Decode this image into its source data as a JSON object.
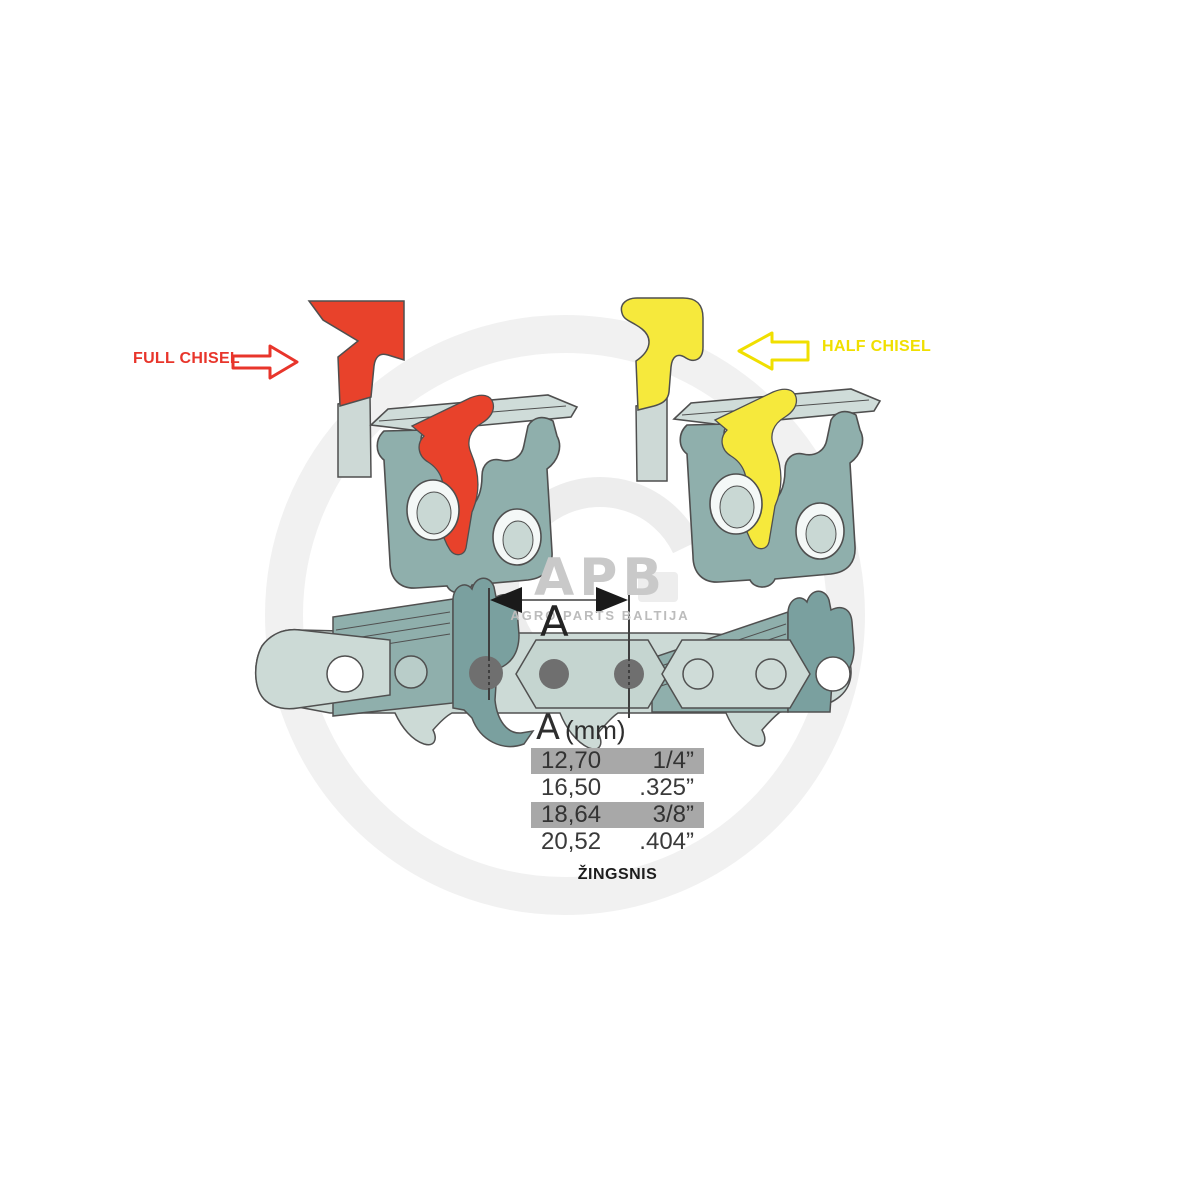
{
  "watermark": {
    "logo": "APB",
    "subtitle": "AGRO PARTS BALTIJA"
  },
  "annotations": {
    "full_chisel": {
      "label": "FULL CHISEL",
      "color": "#e8352b"
    },
    "half_chisel": {
      "label": "HALF CHISEL",
      "color": "#f0df00"
    }
  },
  "dimension": {
    "label": "A"
  },
  "pitch_table": {
    "header": {
      "symbol": "A",
      "unit": "(mm)"
    },
    "rows": [
      {
        "mm": "12,70",
        "inch": "1/4”",
        "highlighted": true
      },
      {
        "mm": "16,50",
        "inch": ".325”",
        "highlighted": false
      },
      {
        "mm": "18,64",
        "inch": "3/8”",
        "highlighted": true
      },
      {
        "mm": "20,52",
        "inch": ".404”",
        "highlighted": false
      }
    ],
    "caption": "ŽINGSNIS"
  },
  "colors": {
    "full_chisel_red": "#e8422b",
    "half_chisel_yellow": "#f6e93c",
    "cutter_teal": "#8fafac",
    "cutter_teal_dark": "#7aa09f",
    "link_pale": "#ccdad6",
    "top_plate_light": "#cfdcd9",
    "rivet_gray": "#6f6f6f",
    "table_row_gray": "#a8a8a8",
    "outline": "#4f4f4f"
  }
}
